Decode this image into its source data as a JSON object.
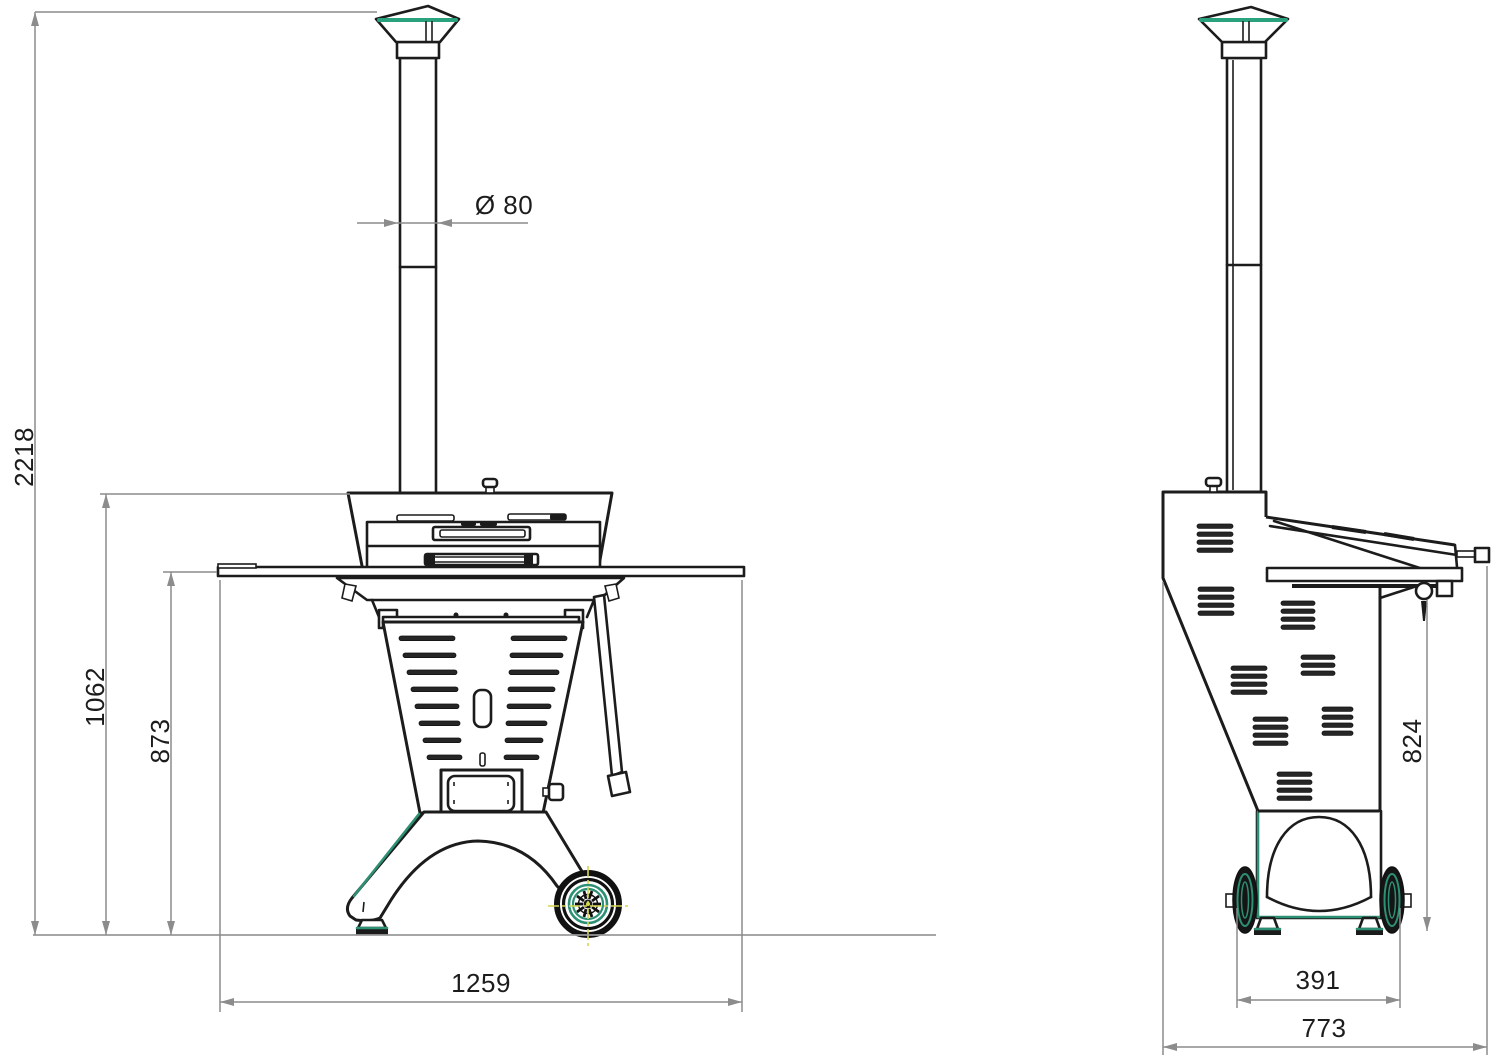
{
  "drawing": {
    "type": "technical-drawing",
    "subject": "outdoor wood-fired oven, front and side elevations with dimensions (mm)",
    "views": {
      "front": {
        "dims": {
          "total_height": "2218",
          "hood_height": "1062",
          "worktop_height": "873",
          "overall_width": "1259",
          "flue_diameter": "Ø 80"
        }
      },
      "side": {
        "dims": {
          "handle_height": "824",
          "wheel_track": "391",
          "overall_depth": "773"
        }
      }
    },
    "colors": {
      "line": "#1c1c1c",
      "dimension": "#8c8c8c",
      "accent_teal": "#2d8f73",
      "highlight_yellow": "#d6d64f",
      "background": "#ffffff"
    }
  }
}
